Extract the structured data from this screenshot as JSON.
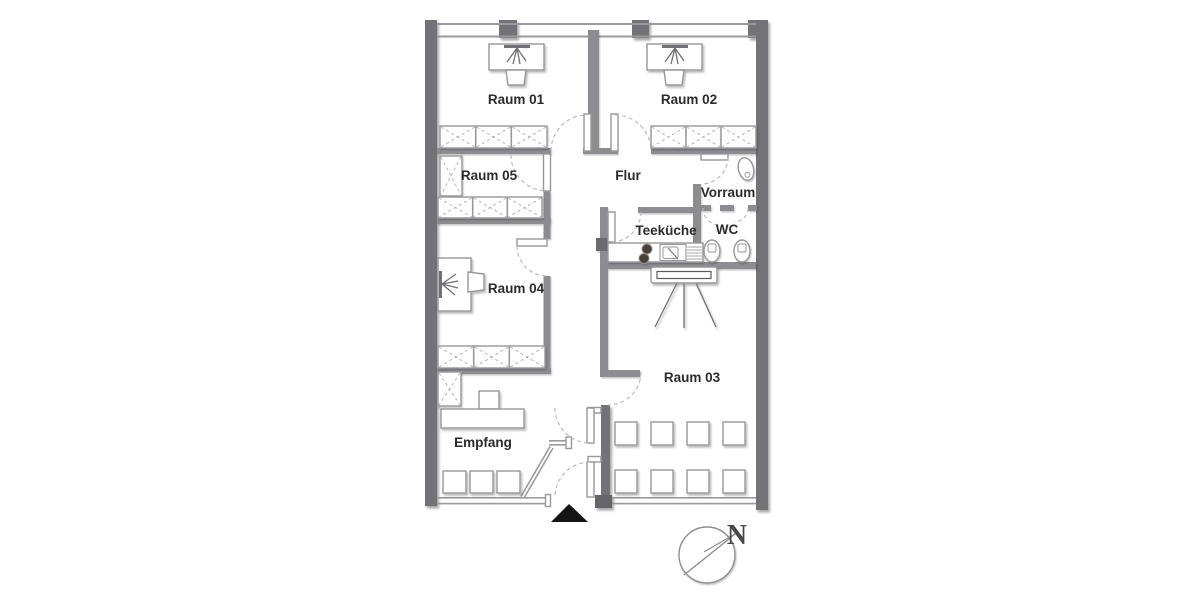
{
  "rooms": {
    "raum01": "Raum 01",
    "raum02": "Raum 02",
    "raum03": "Raum 03",
    "raum04": "Raum 04",
    "raum05": "Raum 05",
    "flur": "Flur",
    "vorraum": "Vorraum",
    "wc": "WC",
    "teekueche": "Teeküche",
    "empfang": "Empfang"
  },
  "compass": {
    "north": "N"
  },
  "fixtures": {
    "desks_with_chair": 3,
    "reception_desk": 1,
    "waiting_chairs_empfang": 3,
    "seminar_chairs_raum03": 8,
    "cabinet_rows": 4,
    "tall_cabinets": 2,
    "stove_burners": 2,
    "kitchen_sink": 1,
    "toilets": 2,
    "washbasin": 1,
    "projector_screen": 1
  },
  "colors": {
    "background": "#ffffff",
    "wall_exterior": "#727277",
    "wall_interior": "#8d8d91",
    "furniture_outline": "#97979b",
    "hatch": "#b4b4b8",
    "door_arc": "#bcbcc0",
    "label_text": "#2b2b2c",
    "entrance_marker": "#151515"
  }
}
